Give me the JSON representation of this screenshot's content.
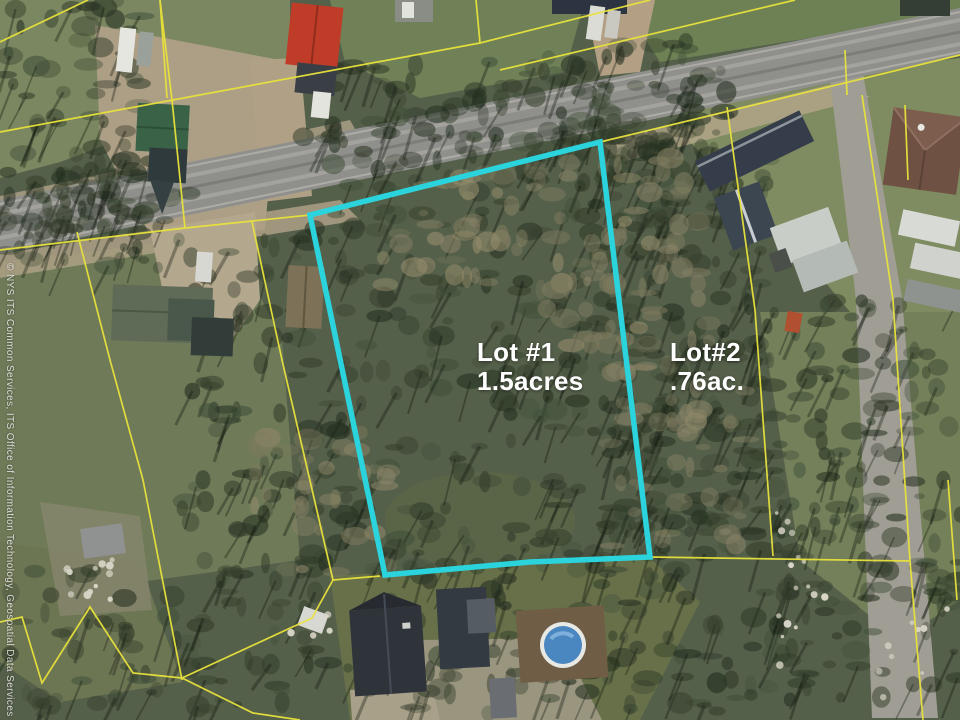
{
  "map": {
    "type": "aerial-parcel-map",
    "lots": {
      "lot1": {
        "name": "Lot #1",
        "size": "1.5acres"
      },
      "lot2": {
        "name": "Lot#2",
        "size": ".76ac."
      }
    },
    "watermark": "© NYS ITS Common Services, ITS Office of Information Technology, Geospatial Data Services",
    "colors": {
      "lot_highlight": "#2bd4dc",
      "parcel_line": "#e8e23c",
      "road": "#8f8f8c",
      "pool_water": "#4a86bf"
    }
  }
}
